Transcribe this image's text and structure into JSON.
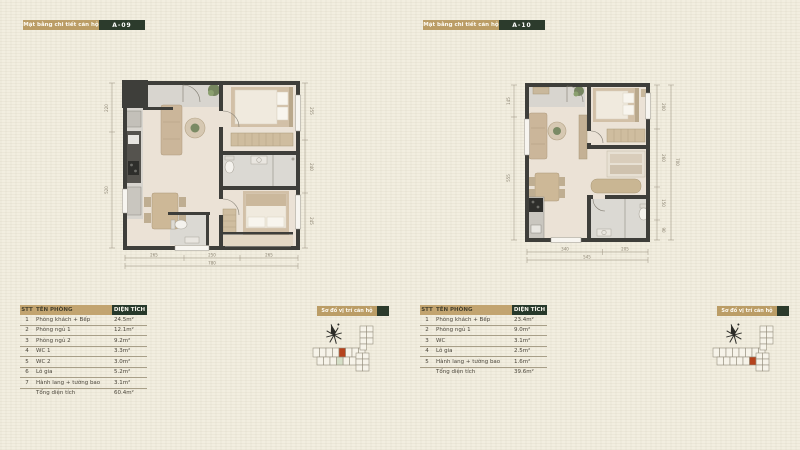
{
  "panels": [
    {
      "header": {
        "label": "Mặt bằng chi tiết căn hộ",
        "unit": "A-09"
      },
      "table": {
        "columns": {
          "stt": "STT",
          "name": "TÊN PHÒNG",
          "area": "DIỆN TÍCH"
        },
        "rows": [
          {
            "stt": "1",
            "name": "Phòng khách + Bếp",
            "area": "24.5m²"
          },
          {
            "stt": "2",
            "name": "Phòng ngủ 1",
            "area": "12.1m²"
          },
          {
            "stt": "3",
            "name": "Phòng ngủ 2",
            "area": "9.2m²"
          },
          {
            "stt": "4",
            "name": "WC 1",
            "area": "3.3m²"
          },
          {
            "stt": "5",
            "name": "WC 2",
            "area": "3.0m²"
          },
          {
            "stt": "6",
            "name": "Lô gia",
            "area": "5.2m²"
          },
          {
            "stt": "7",
            "name": "Hành lang + tường bao",
            "area": "3.1m²"
          }
        ],
        "total": {
          "label": "Tổng diện tích",
          "area": "60.4m²"
        }
      },
      "site_label": "Sơ đồ vị trí căn hộ",
      "dims": {
        "left1": "220",
        "left2": "520",
        "right1": "255",
        "right2": "240",
        "right3": "245",
        "b1": "265",
        "b2": "250",
        "b3": "265",
        "btotal": "780"
      }
    },
    {
      "header": {
        "label": "Mặt bằng chi tiết căn hộ",
        "unit": "A-10"
      },
      "table": {
        "columns": {
          "stt": "STT",
          "name": "TÊN PHÒNG",
          "area": "DIỆN TÍCH"
        },
        "rows": [
          {
            "stt": "1",
            "name": "Phòng khách + Bếp",
            "area": "23.4m²"
          },
          {
            "stt": "2",
            "name": "Phòng ngủ 1",
            "area": "9.0m²"
          },
          {
            "stt": "3",
            "name": "WC",
            "area": "3.1m²"
          },
          {
            "stt": "4",
            "name": "Lô gia",
            "area": "2.5m²"
          },
          {
            "stt": "5",
            "name": "Hành lang + tường bao",
            "area": "1.6m²"
          }
        ],
        "total": {
          "label": "Tổng diện tích",
          "area": "39.6m²"
        }
      },
      "site_label": "Sơ đồ vị trí căn hộ",
      "dims": {
        "left1": "145",
        "left2": "555",
        "right1": "200",
        "right2": "260",
        "right3": "150",
        "right4": "90",
        "rtotal": "700",
        "b1": "340",
        "b2": "205",
        "btotal": "545"
      }
    }
  ]
}
